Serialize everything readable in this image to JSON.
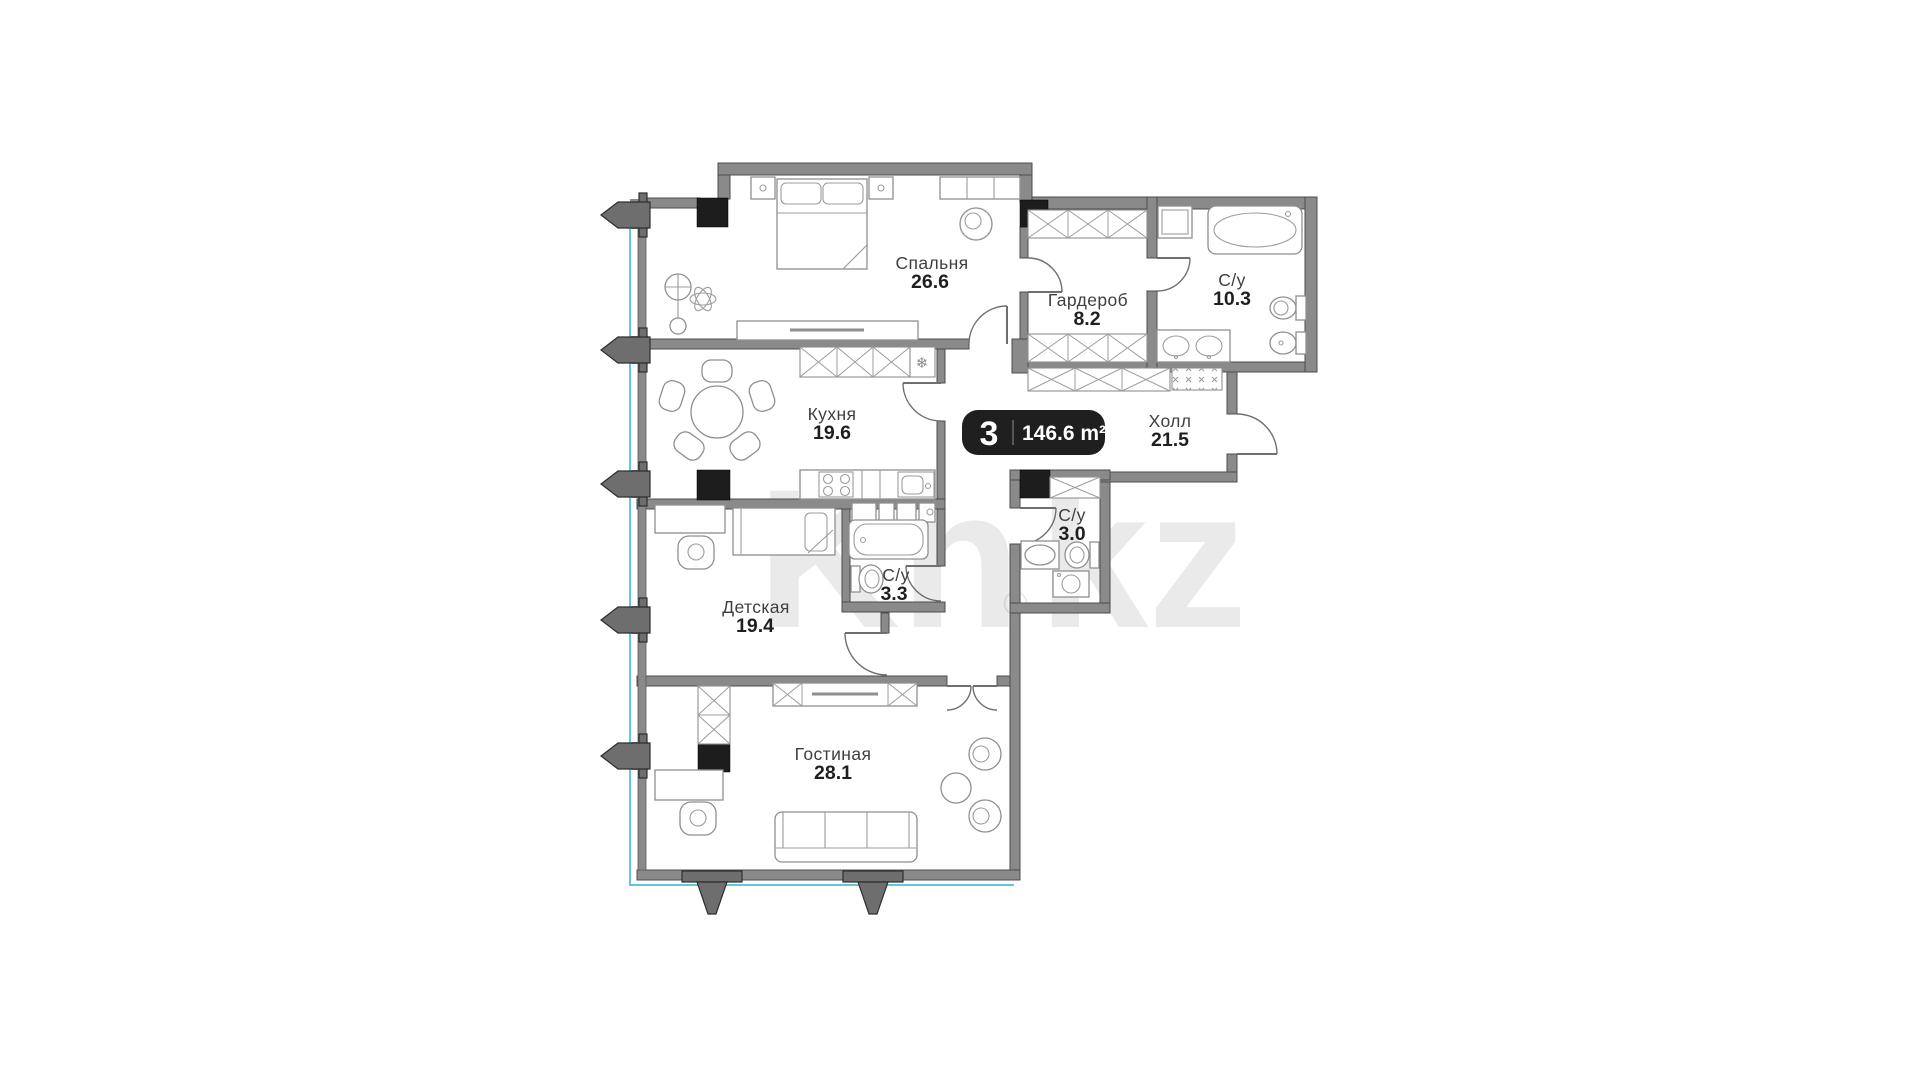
{
  "badge": {
    "rooms_count": "3",
    "total_area": "146.6 m²"
  },
  "rooms": [
    {
      "id": "bedroom",
      "name": "Спальня",
      "area": "26.6"
    },
    {
      "id": "wardrobe",
      "name": "Гардероб",
      "area": "8.2"
    },
    {
      "id": "bathroom-large",
      "name": "С/у",
      "area": "10.3"
    },
    {
      "id": "kitchen",
      "name": "Кухня",
      "area": "19.6"
    },
    {
      "id": "hall",
      "name": "Холл",
      "area": "21.5"
    },
    {
      "id": "bathroom-small",
      "name": "С/у",
      "area": "3.0"
    },
    {
      "id": "bathroom-child",
      "name": "С/у",
      "area": "3.3"
    },
    {
      "id": "children",
      "name": "Детская",
      "area": "19.4"
    },
    {
      "id": "living",
      "name": "Гостиная",
      "area": "28.1"
    }
  ],
  "watermark": {
    "left": "Kn",
    "reg": "®",
    "right": "kz"
  },
  "icons": {
    "fridge_snowflake": "❄"
  },
  "colors": {
    "wall": "#8a8a8a",
    "column": "#1d1d1d",
    "badge_background": "#1f1f1f",
    "badge_text": "#ffffff",
    "glazing_line": "#5fc8de",
    "room_name_text": "#3f3f3f",
    "room_area_text": "#1f1f1f"
  }
}
